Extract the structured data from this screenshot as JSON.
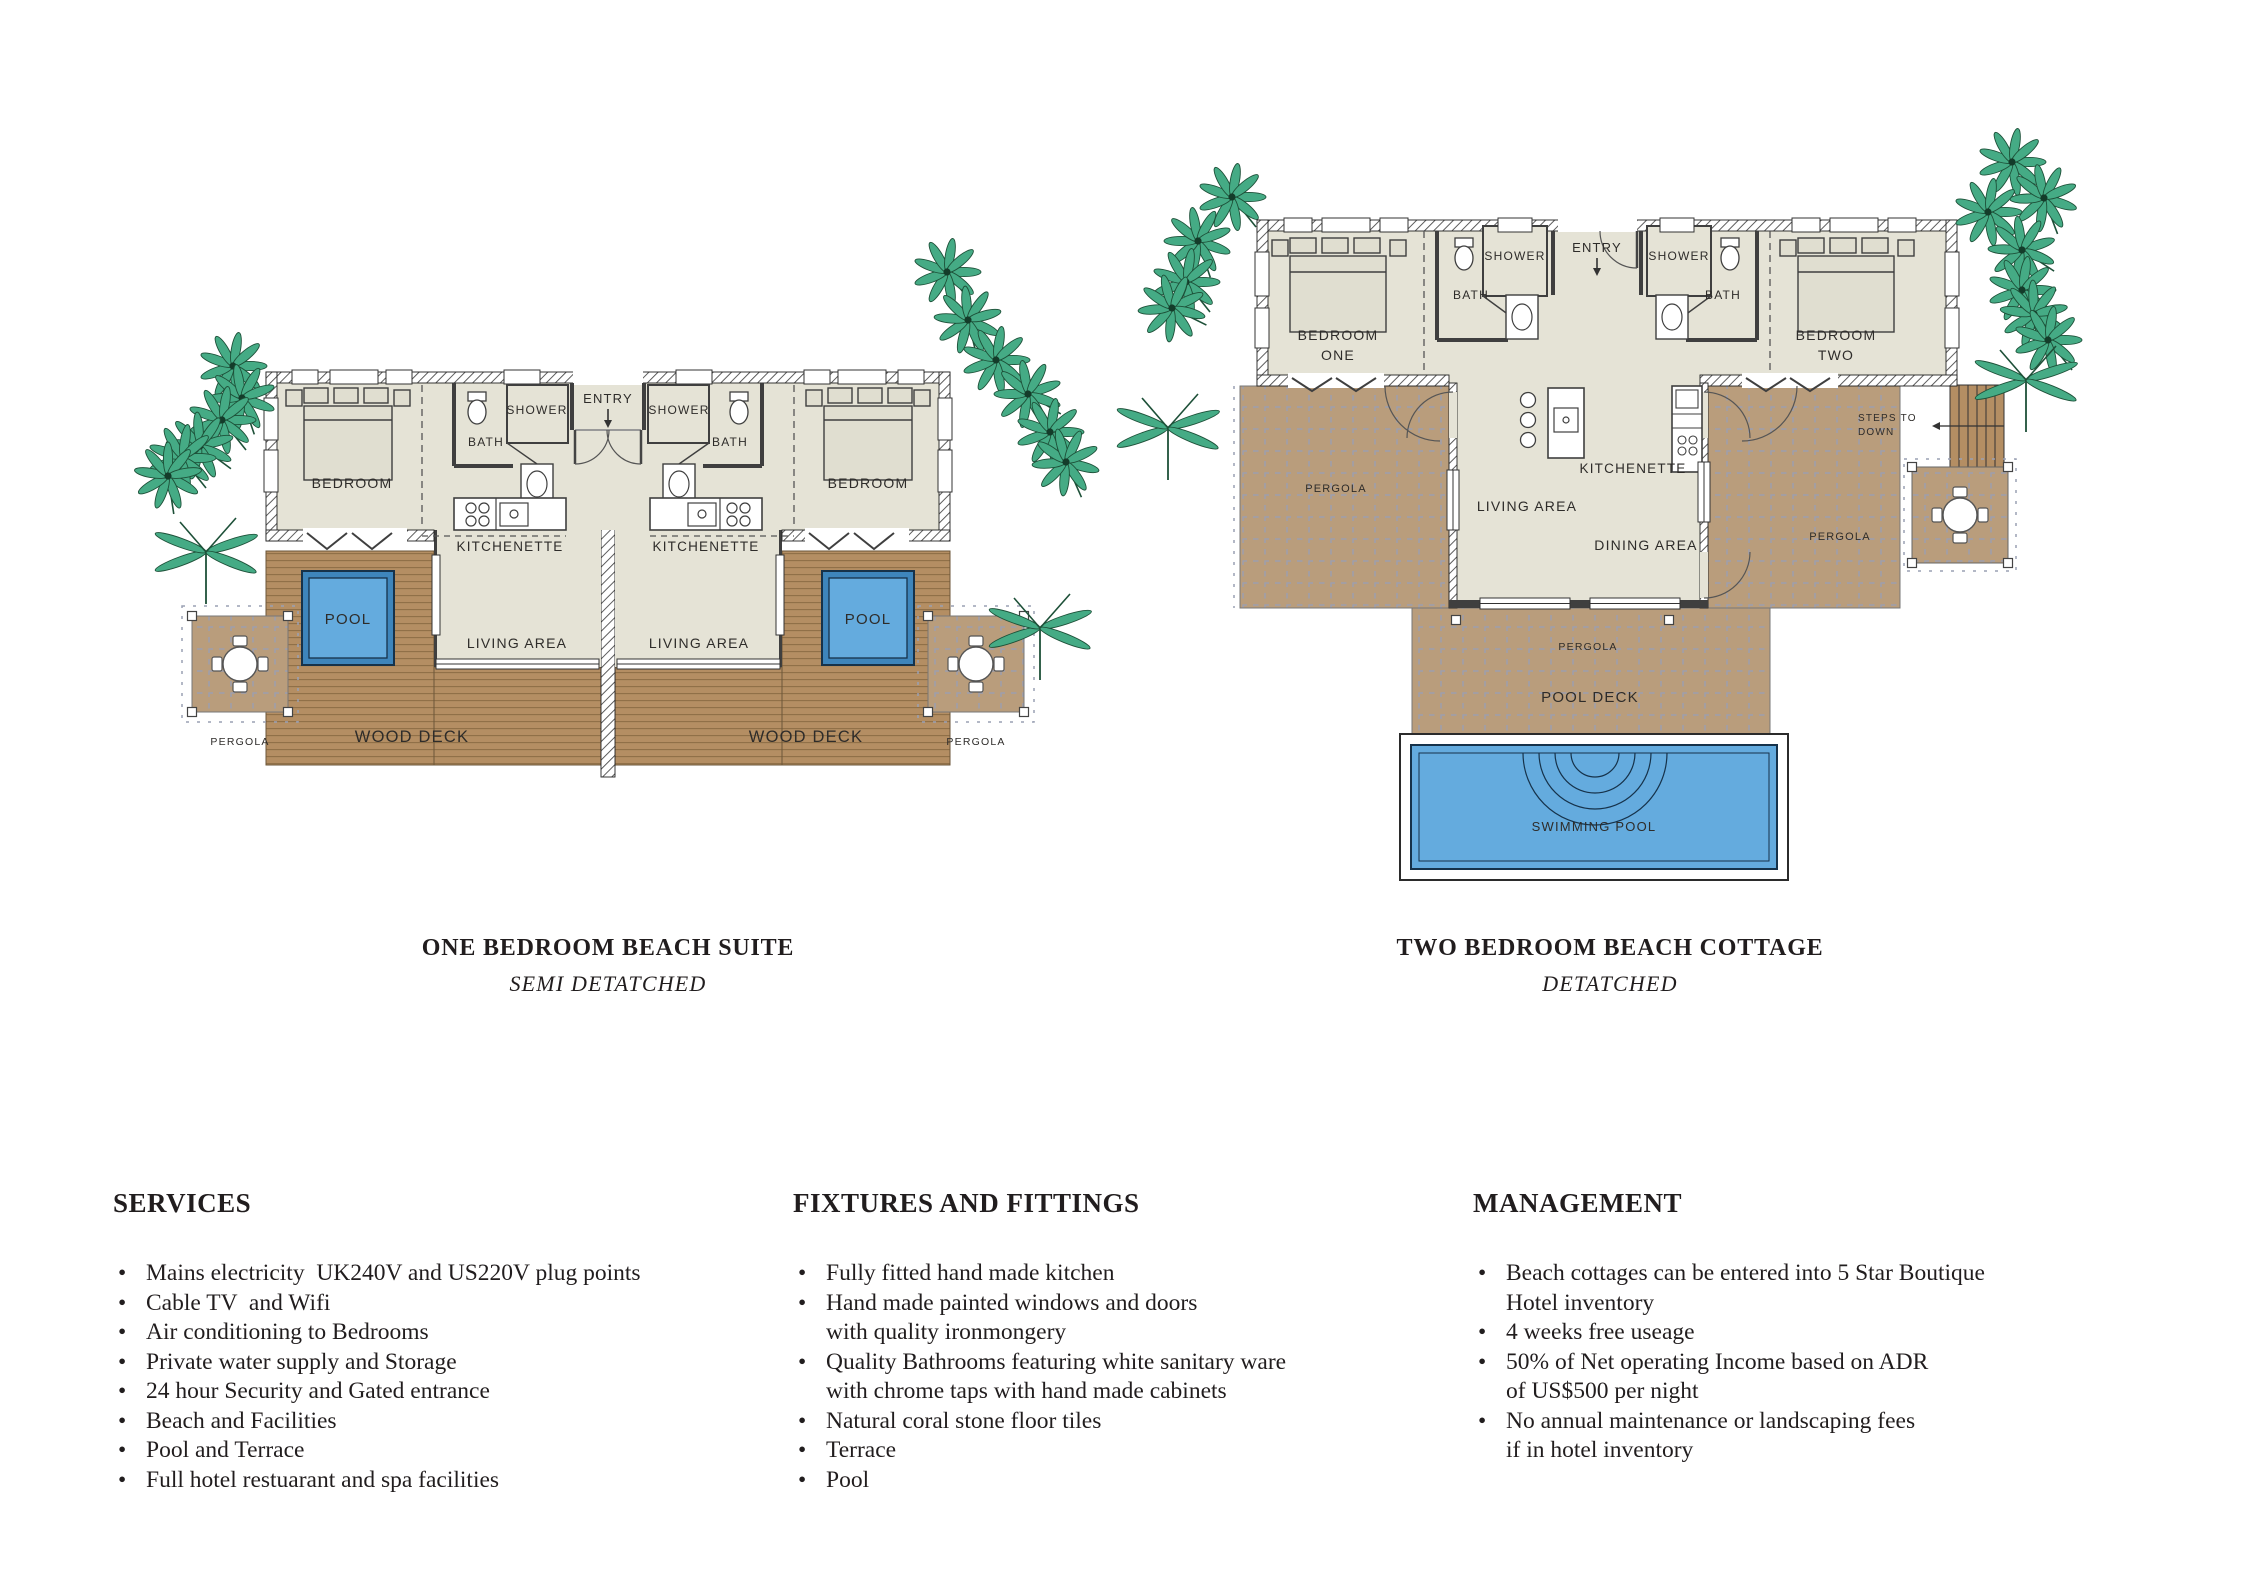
{
  "palette": {
    "room_fill": "#e5e3d6",
    "wall_line": "#444444",
    "wood_deck": "#b48e63",
    "wood_stripe": "#8e6f47",
    "pergola_fill": "#b99d7c",
    "pergola_grid": "#98a0b6",
    "pool_water": "#64abde",
    "pool_edge": "#16324a",
    "palm_green": "#45ab85",
    "text_dark": "#2e2c2a"
  },
  "plan_left": {
    "labels": {
      "entry": "ENTRY",
      "bedroom": "BEDROOM",
      "shower": "SHOWER",
      "bath": "BATH",
      "kitchenette": "KITCHENETTE",
      "living": "LIVING AREA",
      "pool": "POOL",
      "wood_deck": "WOOD DECK",
      "pergola": "PERGOLA"
    },
    "caption_title": "ONE BEDROOM BEACH SUITE",
    "caption_subtitle": "SEMI DETATCHED"
  },
  "plan_right": {
    "labels": {
      "entry": "ENTRY",
      "bedroom_one_line1": "BEDROOM",
      "bedroom_one_line2": "ONE",
      "bedroom_two_line1": "BEDROOM",
      "bedroom_two_line2": "TWO",
      "shower": "SHOWER",
      "bath": "BATH",
      "kitchenette": "KITCHENETTE",
      "living": "LIVING AREA",
      "dining": "DINING AREA",
      "pergola": "PERGOLA",
      "steps_line1": "STEPS TO",
      "steps_line2": "DOWN",
      "pool_deck": "POOL DECK",
      "swimming_pool": "SWIMMING POOL"
    },
    "caption_title": "TWO BEDROOM BEACH COTTAGE",
    "caption_subtitle": "DETATCHED"
  },
  "sections": [
    {
      "heading": "SERVICES",
      "items": [
        [
          "Mains electricity  UK240V and US220V plug points"
        ],
        [
          "Cable TV  and Wifi"
        ],
        [
          "Air conditioning to Bedrooms"
        ],
        [
          "Private water supply and Storage"
        ],
        [
          "24 hour Security and Gated entrance"
        ],
        [
          "Beach and Facilities"
        ],
        [
          "Pool and Terrace"
        ],
        [
          "Full hotel restuarant and spa facilities"
        ]
      ]
    },
    {
      "heading": "FIXTURES AND FITTINGS",
      "items": [
        [
          "Fully fitted hand made kitchen"
        ],
        [
          "Hand made painted windows and doors",
          "with quality ironmongery"
        ],
        [
          "Quality Bathrooms featuring white sanitary ware",
          "with chrome taps with hand made cabinets"
        ],
        [
          "Natural coral stone floor tiles"
        ],
        [
          "Terrace"
        ],
        [
          "Pool"
        ]
      ]
    },
    {
      "heading": "MANAGEMENT",
      "items": [
        [
          "Beach cottages can be entered into 5 Star Boutique",
          "Hotel inventory"
        ],
        [
          "4 weeks free useage"
        ],
        [
          "50% of Net operating Income based on ADR",
          "of US$500 per night"
        ],
        [
          "No annual maintenance or landscaping fees",
          "if in hotel inventory"
        ]
      ]
    }
  ]
}
